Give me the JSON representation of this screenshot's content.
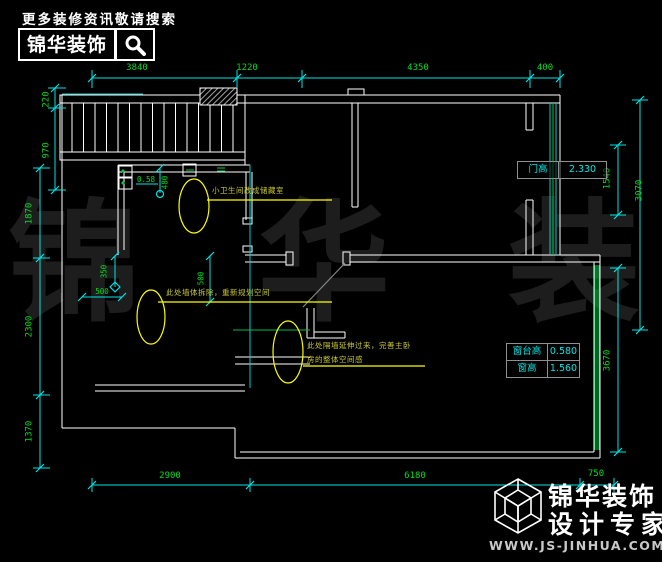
{
  "header": {
    "tagline": "更多装修资讯敬请搜索",
    "brand": "锦华装饰",
    "search_icon": "magnifier"
  },
  "watermark": "锦 华 装 饰",
  "dims": {
    "top1": "3840",
    "top2": "1220",
    "top3": "4350",
    "top4": "400",
    "left1": "220",
    "left2": "970",
    "left3": "1870",
    "left4": "2300",
    "left5": "1370",
    "right1": "1540",
    "right2": "3070",
    "right3": "3670",
    "bottom1": "2900",
    "bottom2": "6180",
    "bottom3": "750",
    "i480": "480",
    "i058": "0.58",
    "i350": "350",
    "i500h": "500",
    "i500v": "500"
  },
  "tables": {
    "door": {
      "label": "门高",
      "value": "2.330"
    },
    "window": {
      "rows": [
        {
          "label": "窗台高",
          "value": "0.580"
        },
        {
          "label": "窗高",
          "value": "1.560"
        }
      ]
    }
  },
  "annotations": {
    "a1": "小卫生间改成储藏室",
    "a2": "此处墙体拆除，重新规划空间",
    "a3_line1": "此处隔墙延伸过来，完善主卧",
    "a3_line2": "房的整体空间感"
  },
  "footer": {
    "brand": "锦华装饰",
    "subtitle": "设计专家",
    "website": "WWW.JS-JINHUA.COM",
    "logo_icon": "wireframe-cube"
  },
  "colors": {
    "background": "#000000",
    "wall": "#ffffff",
    "dim_line": "#00e5e5",
    "dim_text": "#00dd22",
    "window_line": "#00cc44",
    "annotation": "#c8c832",
    "watermark": "#1d1d1d",
    "door_swing": "#888888"
  }
}
